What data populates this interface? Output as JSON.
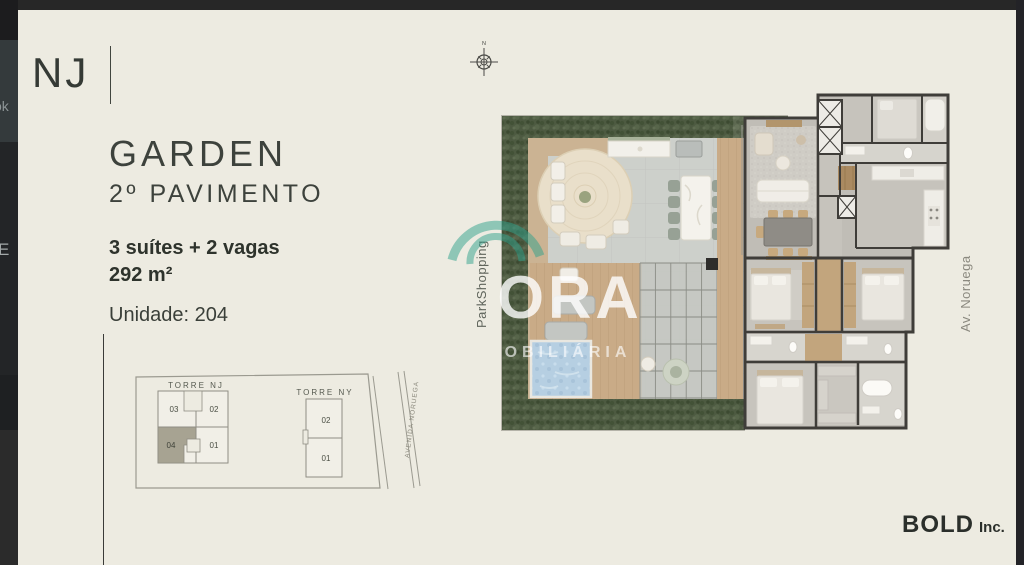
{
  "chrome": {
    "frag1": "ok",
    "frag2": "E"
  },
  "panel": {
    "logo": "NJ",
    "title": "GARDEN",
    "subtitle": "2º PAVIMENTO",
    "spec1": "3 suítes + 2 vagas",
    "spec2": "292 m²",
    "unit": "Unidade: 204"
  },
  "keyplan": {
    "nj_label": "TORRE NJ",
    "ny_label": "TORRE NY",
    "nj_units": {
      "u03": "03",
      "u02": "02",
      "u04": "04",
      "u01": "01"
    },
    "ny_units": {
      "u02": "02",
      "u01": "01"
    },
    "street": "AVENIDA NORUEGA",
    "highlight_color": "#a7a392"
  },
  "plan": {
    "compass": "N",
    "left_street": "ParkShopping",
    "right_street": "Av. Noruega"
  },
  "watermark": {
    "main": "ORA",
    "sub": "OBILIÁRIA",
    "accent": "#2fa18c"
  },
  "footer": {
    "brand": "BOLD",
    "suffix": "Inc."
  },
  "colors": {
    "slide_bg": "#edebe1",
    "hedge": "#4d5a41",
    "deck_wood": "#c9ab87",
    "pool": "#b6cfe2",
    "walls": "#3f3d39",
    "unit_highlight": "#a7a392",
    "watermark_teal": "#2fa18c"
  }
}
